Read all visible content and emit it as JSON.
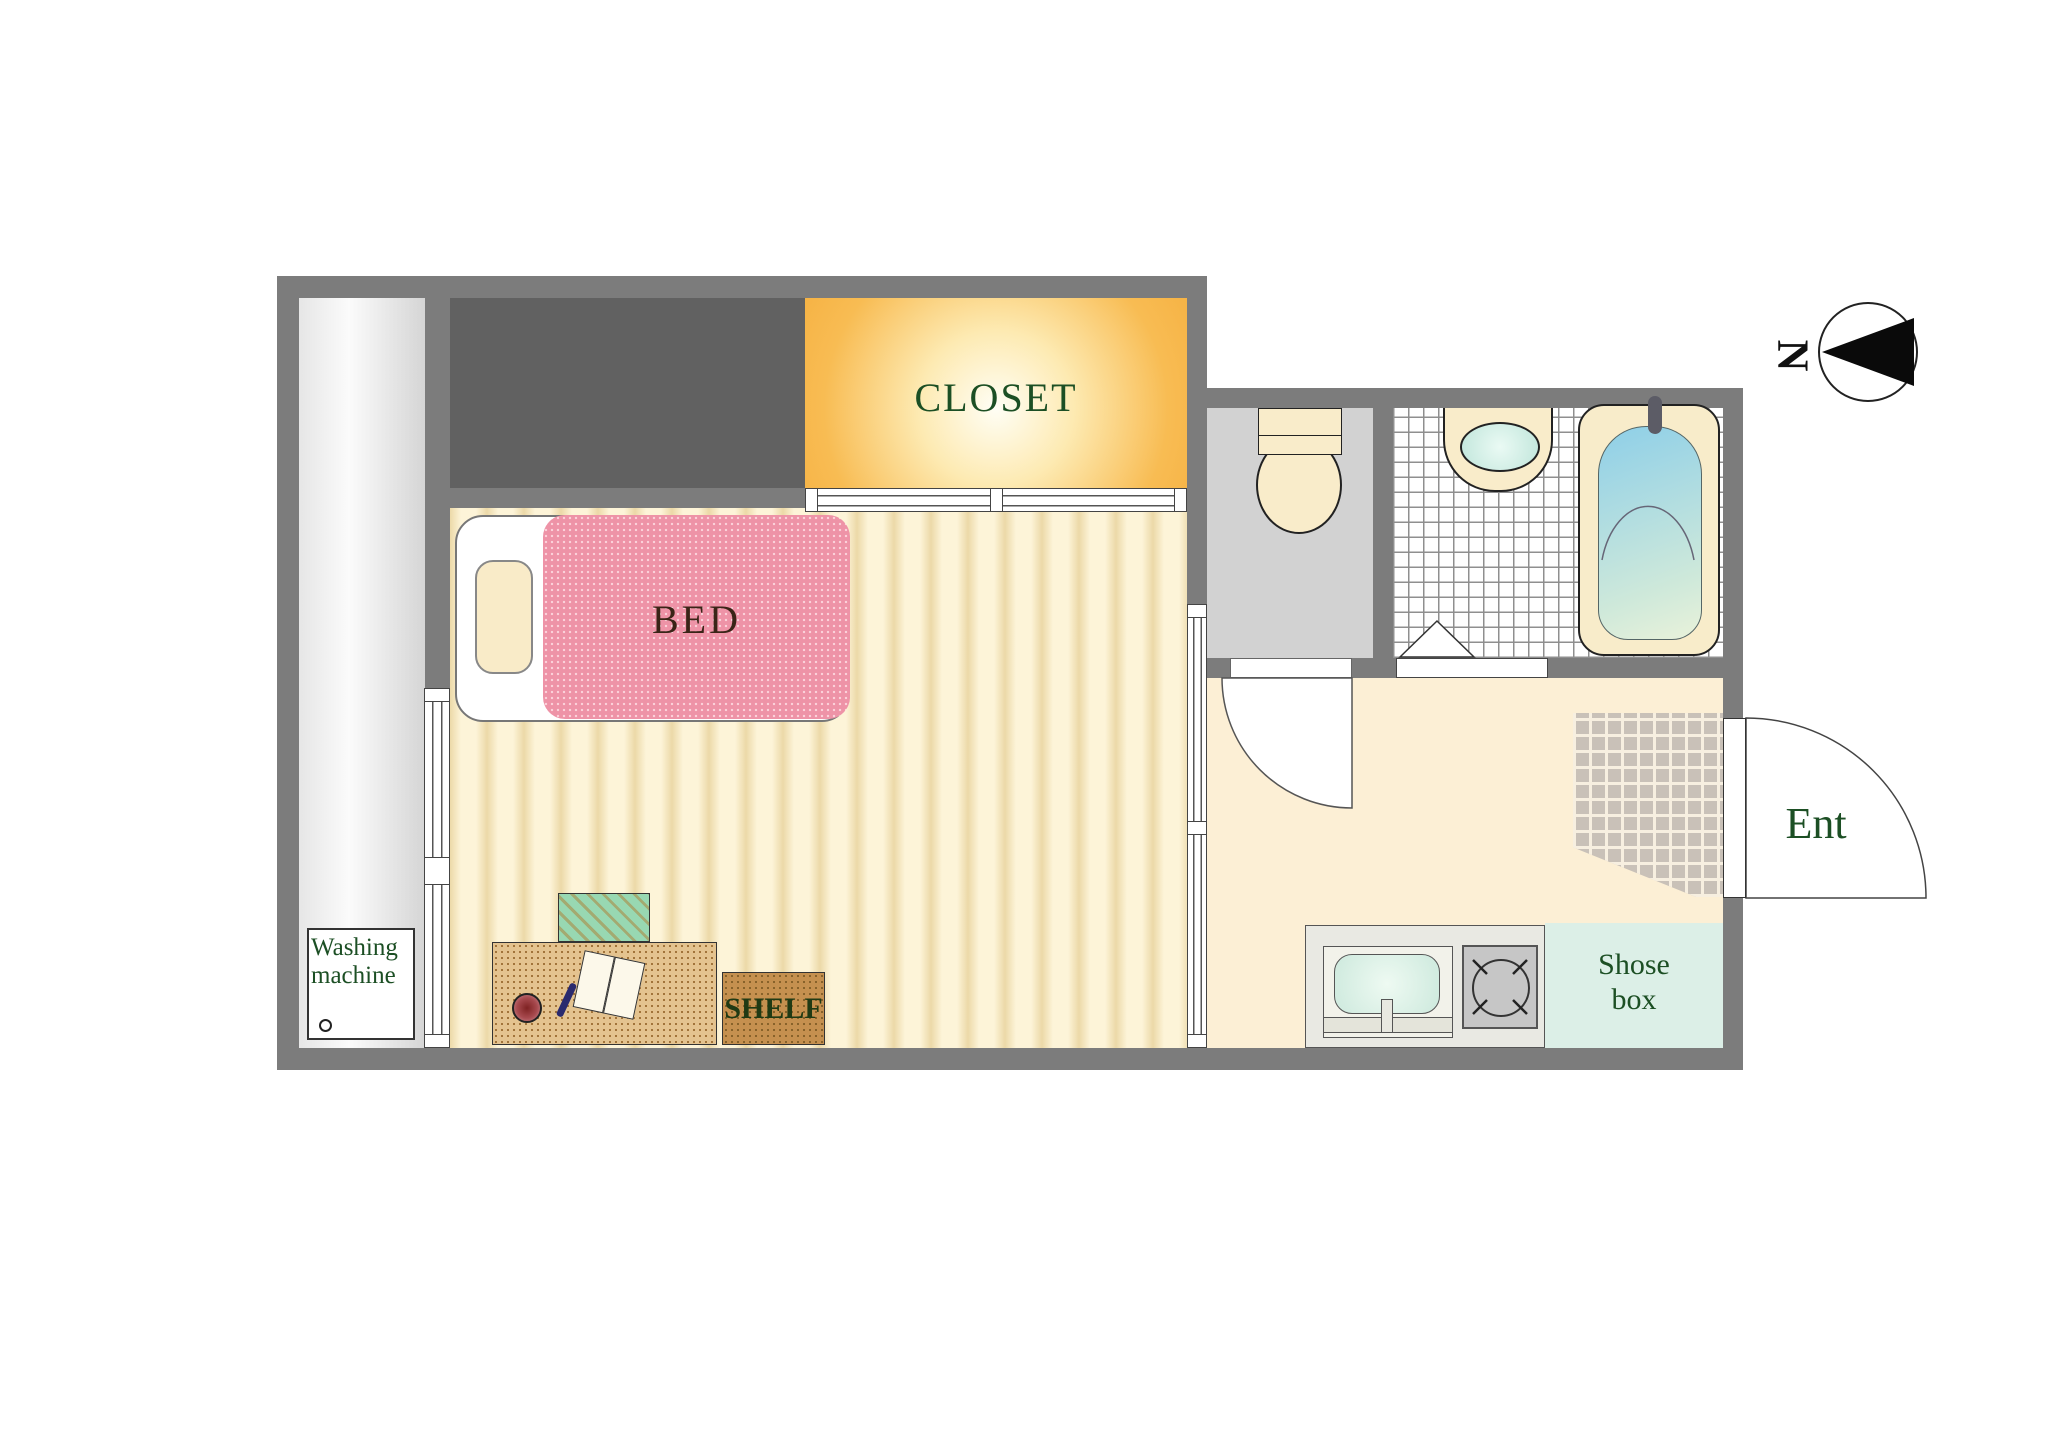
{
  "title": "One-room apartment floor plan",
  "labels": {
    "closet": "CLOSET",
    "bed": "BED",
    "shelf": "SHELF",
    "washing_machine": "Washing machine",
    "shoe_box": "Shose box",
    "entrance": "Ent",
    "compass_north": "N"
  },
  "colors": {
    "wall": "#7c7c7c",
    "storage_area": "#616161",
    "closet_fill": "#f6b345",
    "bed_mattress": "#ee93a7",
    "floor_stripe_light": "#fdf4d8",
    "floor_stripe_dark": "#ecd9a8",
    "hall_floor": "#fcefd5",
    "toilet_floor": "#d2d2d2",
    "shoe_box_bg": "#dcefe7",
    "tub_water": "#8ecfe8",
    "label_green": "#1c4f24",
    "desk_wood": "#e4c38f",
    "shelf_wood": "#c5904f",
    "cushion_green": "#98d8b2"
  }
}
